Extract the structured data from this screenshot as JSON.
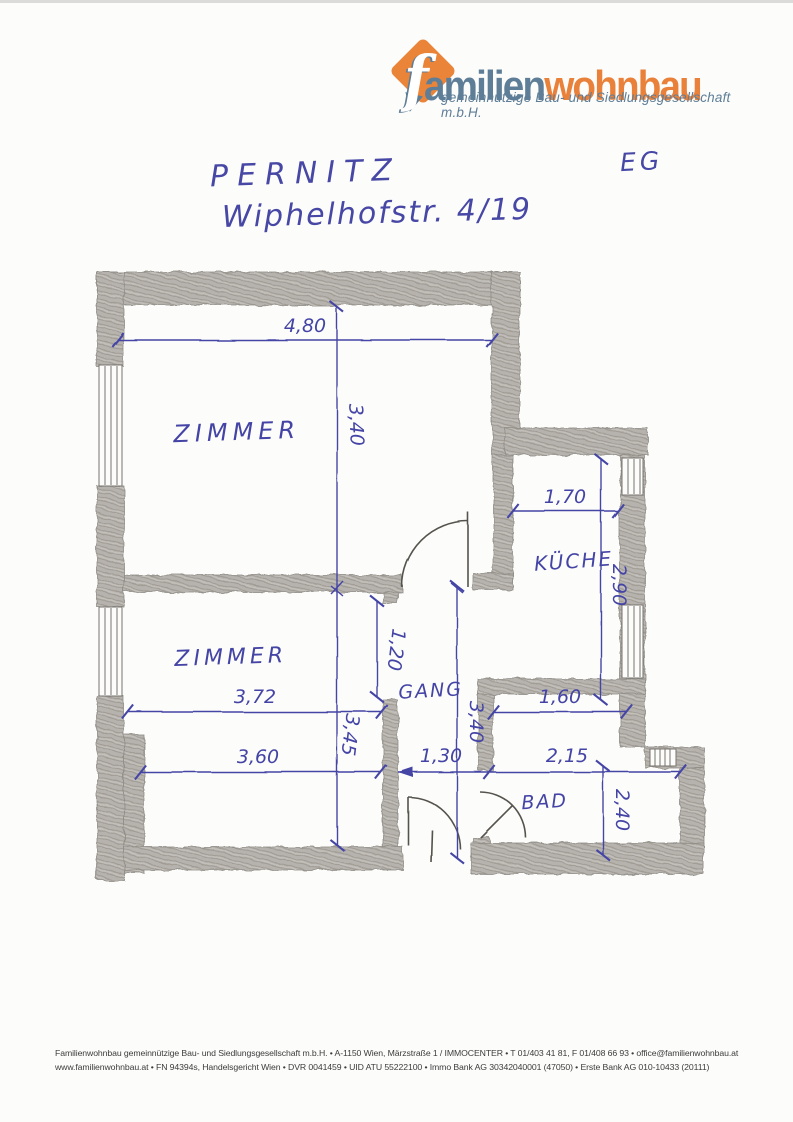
{
  "logo": {
    "name_part1": "familien",
    "name_part2": "wohnbau",
    "tagline": "gemeinnützige Bau- und Siedlungsgesellschaft m.b.H.",
    "colors": {
      "blue_gray": "#5e7e98",
      "orange": "#e9813a"
    }
  },
  "handwriting": {
    "place": "PERNITZ",
    "address": "Wiphelhofstr. 4/19",
    "floor_label": "EG",
    "ink_color": "#4747a6"
  },
  "floorplan": {
    "rooms": {
      "room1": "ZIMMER",
      "room2": "ZIMMER",
      "kitchen": "KÜCHE",
      "hall": "GANG",
      "bath": "BAD"
    },
    "dims": {
      "room1_width": "4,80",
      "room1_depth": "3,40",
      "kitchen_width": "1,70",
      "kitchen_depth": "2,90",
      "door_opening": "1,20",
      "room2_width": "3,72",
      "room2_depth": "3,45",
      "hall_depth": "3,40",
      "bath_niche_width": "1,60",
      "room2_width_bottom": "3,60",
      "hall_width": "1,30",
      "bath_width": "2,15",
      "bath_depth": "2,40"
    },
    "colors": {
      "pencil_wall": "#b6b3ae",
      "ink": "#4444a6",
      "paper": "#fcfcfa"
    }
  },
  "footer": {
    "line1": "Familienwohnbau gemeinnützige Bau- und Siedlungsgesellschaft m.b.H. • A-1150 Wien, Märzstraße 1 / IMMOCENTER • T 01/403 41 81, F 01/408 66 93 • office@familienwohnbau.at",
    "line2": "www.familienwohnbau.at • FN 94394s, Handelsgericht Wien • DVR 0041459 • UID ATU 55222100 • Immo Bank AG 30342040001 (47050) • Erste Bank AG 010-10433 (20111)"
  }
}
